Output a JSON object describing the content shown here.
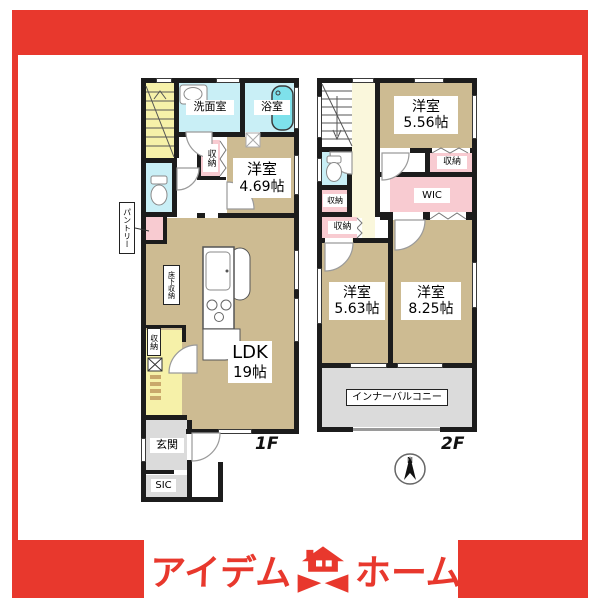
{
  "colors": {
    "accent_red": "#E8382D",
    "room_tan": "#CDBB92",
    "hall_yellow": "#F6F1A9",
    "hall_cream": "#FAF7DC",
    "wet_cyan": "#C9EFF6",
    "tub_cyan": "#7EE1EB",
    "closet_pink": "#F8CBD1",
    "entrance_gray": "#DBDBDB",
    "wall_black": "#1c1c1c"
  },
  "logo": {
    "text_left": "アイデム",
    "text_right": "ホーム"
  },
  "floor1": {
    "label": "1F",
    "washroom": "洗面室",
    "bath": "浴室",
    "bedroom_name": "洋室",
    "bedroom_size": "4.69帖",
    "bedroom_closet": "収納",
    "pantry": "パントリー",
    "underfloor_storage": "床下収納",
    "hall_closet": "収納",
    "ldk_name": "LDK",
    "ldk_size": "19帖",
    "entrance": "玄関",
    "shoe_closet": "SIC"
  },
  "floor2": {
    "label": "2F",
    "bedroom_a_name": "洋室",
    "bedroom_a_size": "5.56帖",
    "closet_a": "収納",
    "closet_b": "収納",
    "closet_c": "収納",
    "wic": "WIC",
    "bedroom_b_name": "洋室",
    "bedroom_b_size": "5.63帖",
    "bedroom_c_name": "洋室",
    "bedroom_c_size": "8.25帖",
    "balcony": "インナーバルコニー"
  },
  "compass": {
    "north": "N"
  }
}
